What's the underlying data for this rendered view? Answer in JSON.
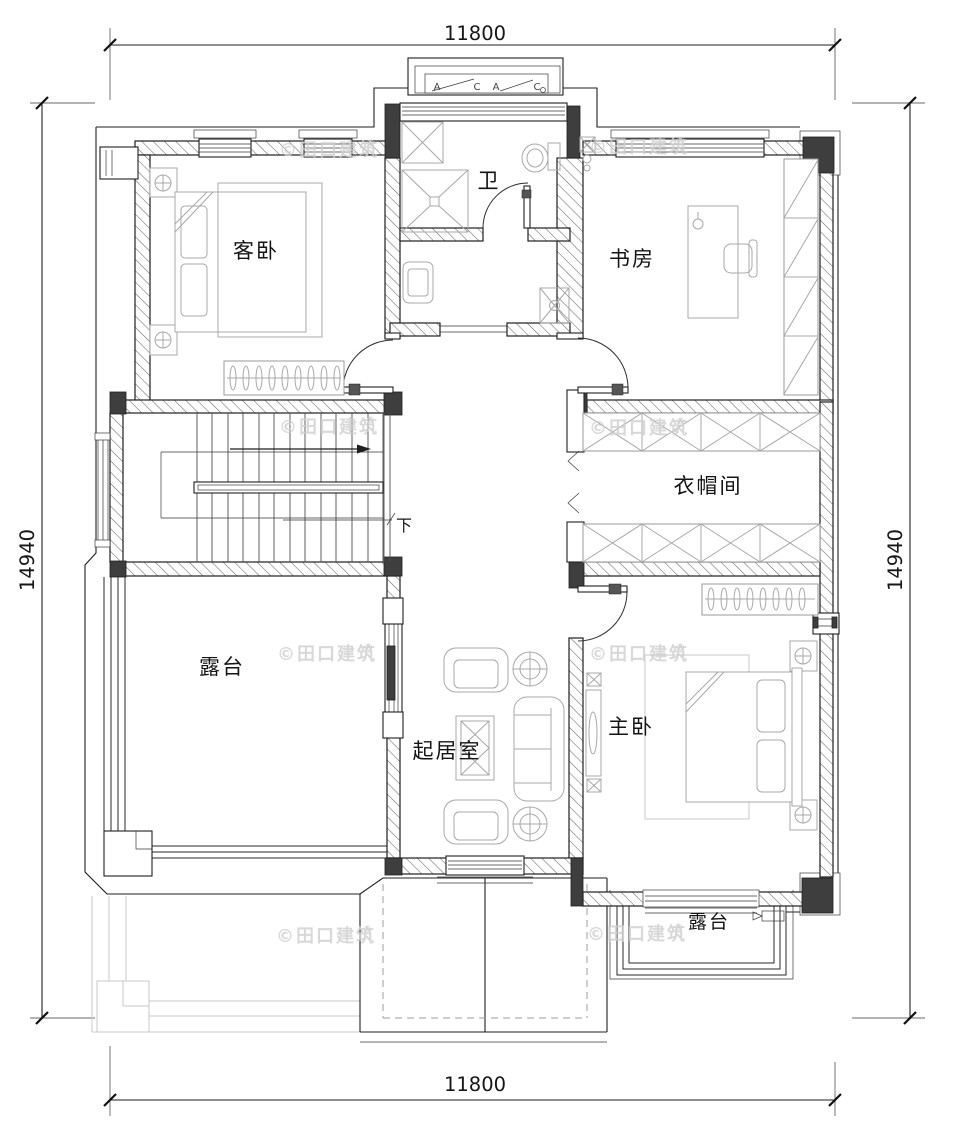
{
  "drawing": {
    "dimensions": {
      "top": "11800",
      "bottom": "11800",
      "left": "14940",
      "right": "14940"
    },
    "rooms": {
      "guest_bedroom": "客卧",
      "bathroom": "卫",
      "study": "书房",
      "cloakroom": "衣帽间",
      "terrace_west": "露台",
      "living_room": "起居室",
      "master_bedroom": "主卧",
      "terrace_south": "露台"
    },
    "stairs_down_label": "下",
    "window_tags": [
      "A",
      "C",
      "A",
      "C"
    ],
    "watermark": {
      "text": "©田口建筑",
      "reg": "®"
    },
    "colors": {
      "background": "#ffffff",
      "line": "#1f1f1f",
      "column_fill": "#3e3e3e",
      "hatch": "#6a6a6a",
      "furniture": "#a8a8a8",
      "underlay": "#c8c8c8",
      "watermark": "#cfcfcf"
    }
  }
}
